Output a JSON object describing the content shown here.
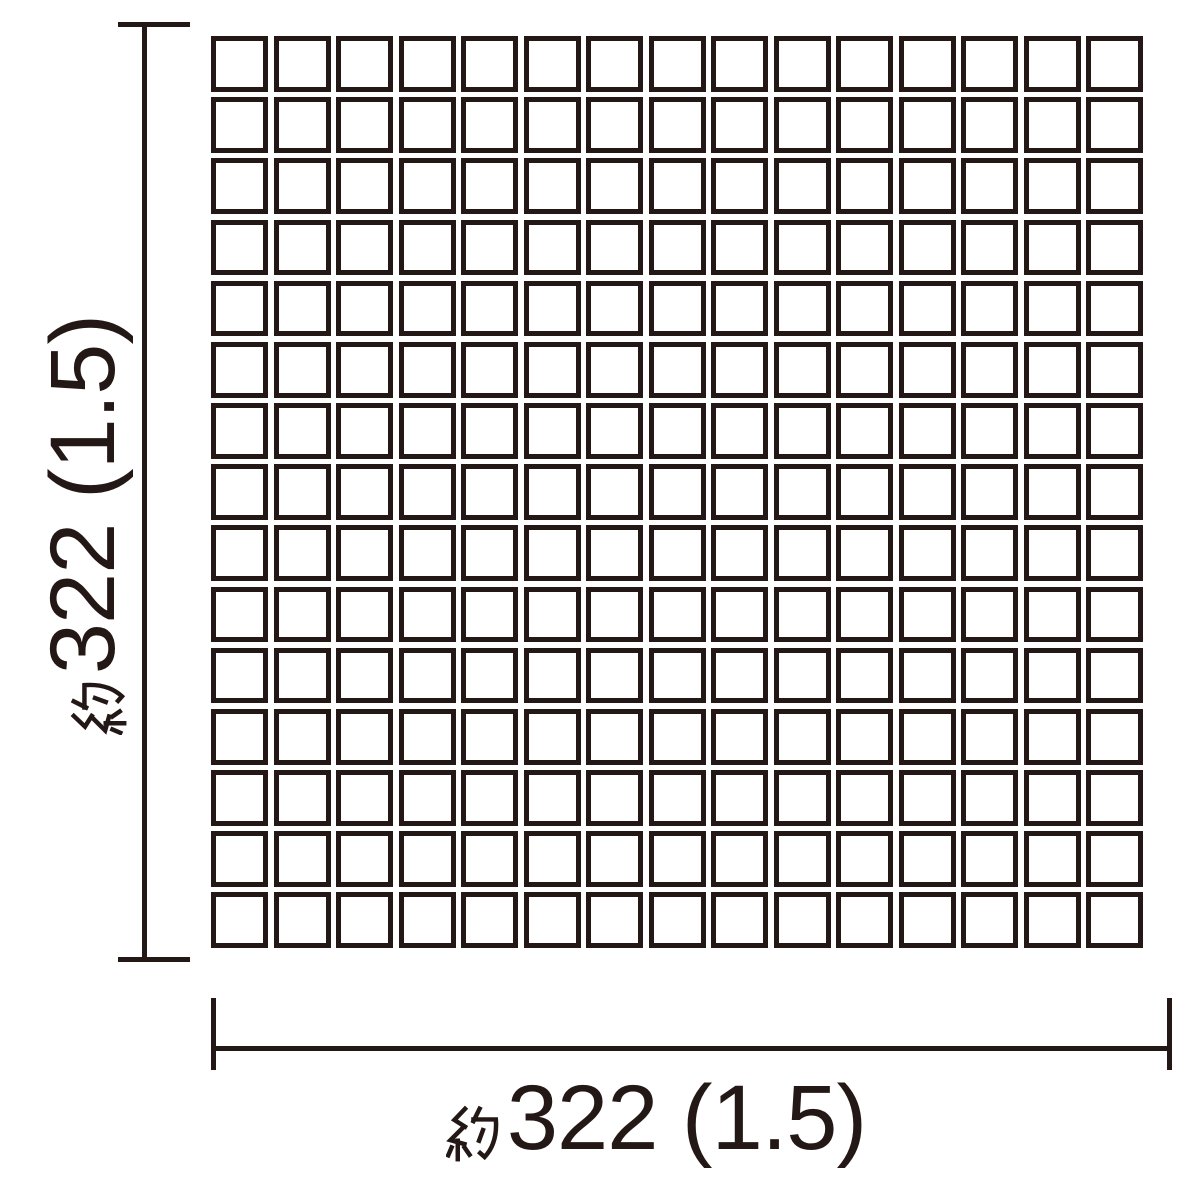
{
  "diagram_type": "mosaic tile sheet dimension drawing",
  "grid": {
    "rows": 15,
    "columns": 15,
    "tile_shape": "square",
    "tile_fill": "#ffffff",
    "tile_border_color": "#231815"
  },
  "dimensions": {
    "width": {
      "label": "約322（1.5）",
      "kanji_prefix": "約",
      "value_text": "322 (1.5)",
      "orientation": "horizontal"
    },
    "height": {
      "label": "約322（1.5）",
      "kanji_prefix": "約",
      "value_text": "322 (1.5)",
      "orientation": "vertical-rotated-90ccw"
    }
  },
  "colors": {
    "ink": "#231815",
    "bg": "#ffffff",
    "tile": "#ffffff"
  }
}
